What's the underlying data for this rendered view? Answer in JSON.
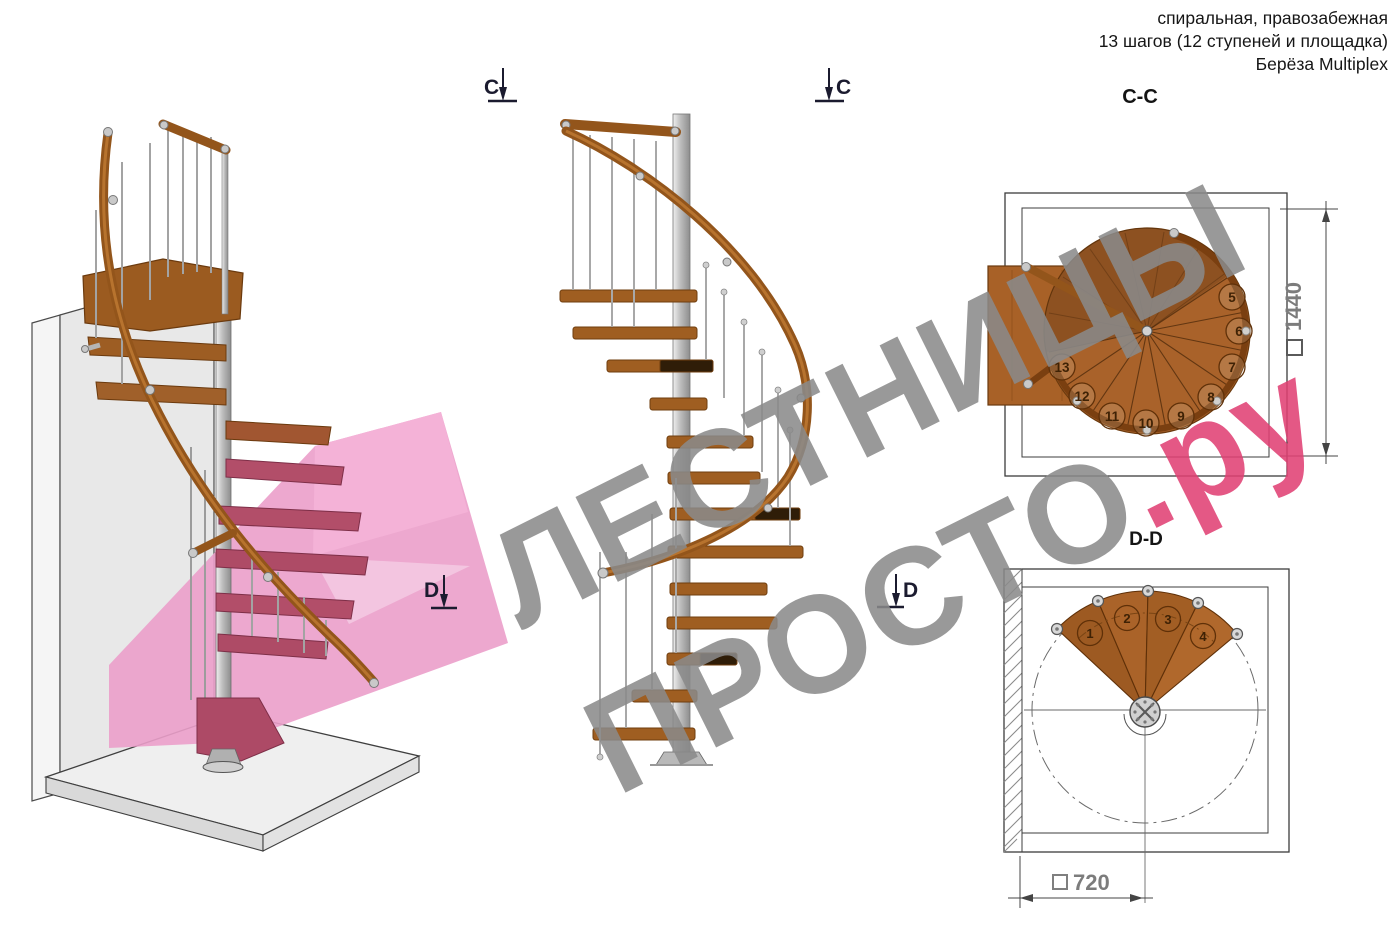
{
  "header": {
    "line1": "спиральная, правозабежная",
    "line2": "13 шагов (12 ступеней и площадка)",
    "line3": "Берёза Multiplex"
  },
  "watermark": {
    "line1": "ЛЕСТНИЦЫ",
    "line2_gray": "ПРОСТО",
    "line2_pink": ".ру"
  },
  "views": {
    "perspective": {
      "description": "3d-render-spiral-staircase",
      "marker_d": "D"
    },
    "elevation": {
      "marker_c_left": "C",
      "marker_c_right": "C",
      "marker_d": "D"
    },
    "plan_cc": {
      "label": "C-C",
      "dimension": "1440",
      "square_symbol": "□",
      "steps": [
        "5",
        "6",
        "7",
        "8",
        "9",
        "10",
        "11",
        "12",
        "13"
      ]
    },
    "plan_dd": {
      "label": "D-D",
      "dimension": "720",
      "square_symbol": "□",
      "steps": [
        "1",
        "2",
        "3",
        "4"
      ]
    }
  },
  "colors": {
    "wood": "#a9622a",
    "wood_dark": "#7a3f10",
    "rail": "#93551b",
    "steel": "#c9c9c9",
    "wall": "#e8e8e8",
    "floor": "#efefef",
    "section_plane_pink": "#eb9fca",
    "cut_step_pink": "#b24e69",
    "watermark_gray": "#8a8a8a",
    "watermark_pink": "#e03f73",
    "drawing_line": "#3c3c3c",
    "dimension_text": "#7c7c7c"
  }
}
